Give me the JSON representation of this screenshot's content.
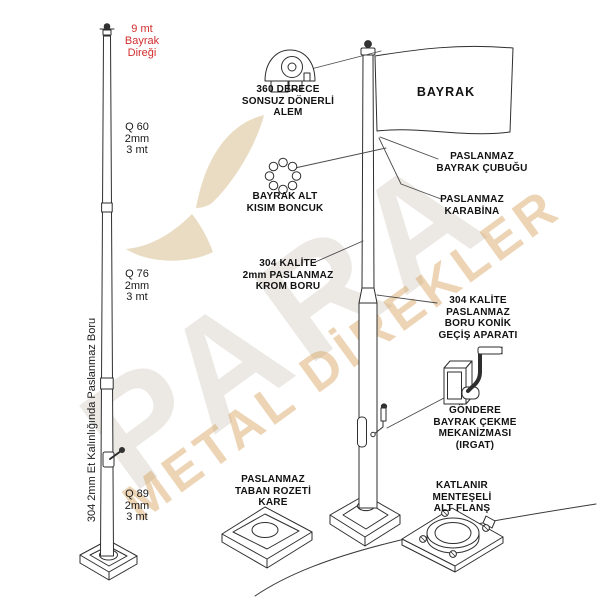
{
  "diagram": {
    "pole_title": {
      "text": "9 mt\nBayrak\nDireği",
      "color": "#d22d2d"
    },
    "left_pole_sections": [
      {
        "label": "Q 60\n2mm\n3 mt"
      },
      {
        "label": "Q 76\n2mm\n3 mt"
      },
      {
        "label": "Q 89\n2mm\n3 mt"
      }
    ],
    "left_pole_note": "304 2mm Et Kalınlığında Paslanmaz Boru",
    "flag_label": "BAYRAK",
    "parts": {
      "alem": "360 DERECE\nSONSUZ DÖNERLİ\nALEM",
      "boncuk": "BAYRAK ALT\nKISIM BONCUK",
      "krom_boru": "304 KALİTE\n2mm PASLANMAZ\nKROM BORU",
      "bayrak_cubugu": "PASLANMAZ\nBAYRAK ÇUBUĞU",
      "karabina": "PASLANMAZ\nKARABİNA",
      "konik_gecis": "304 KALİTE\nPASLANMAZ\nBORU KONİK\nGEÇİŞ APARATI",
      "irgat": "GÖNDERE\nBAYRAK ÇEKME\nMEKANİZMASI\n(IRGAT)",
      "taban_rozeti": "PASLANMAZ\nTABAN ROZETİ\nKARE",
      "alt_flans": "KATLANIR\nMENTEŞELİ\nALT FLANŞ"
    }
  },
  "watermark": {
    "brand": "PARA",
    "tagline": "METAL DİREKLER",
    "brand_color": "#ccc5ba",
    "tagline_color": "#d5a05a",
    "swoosh_color": "#e9dcc3"
  }
}
